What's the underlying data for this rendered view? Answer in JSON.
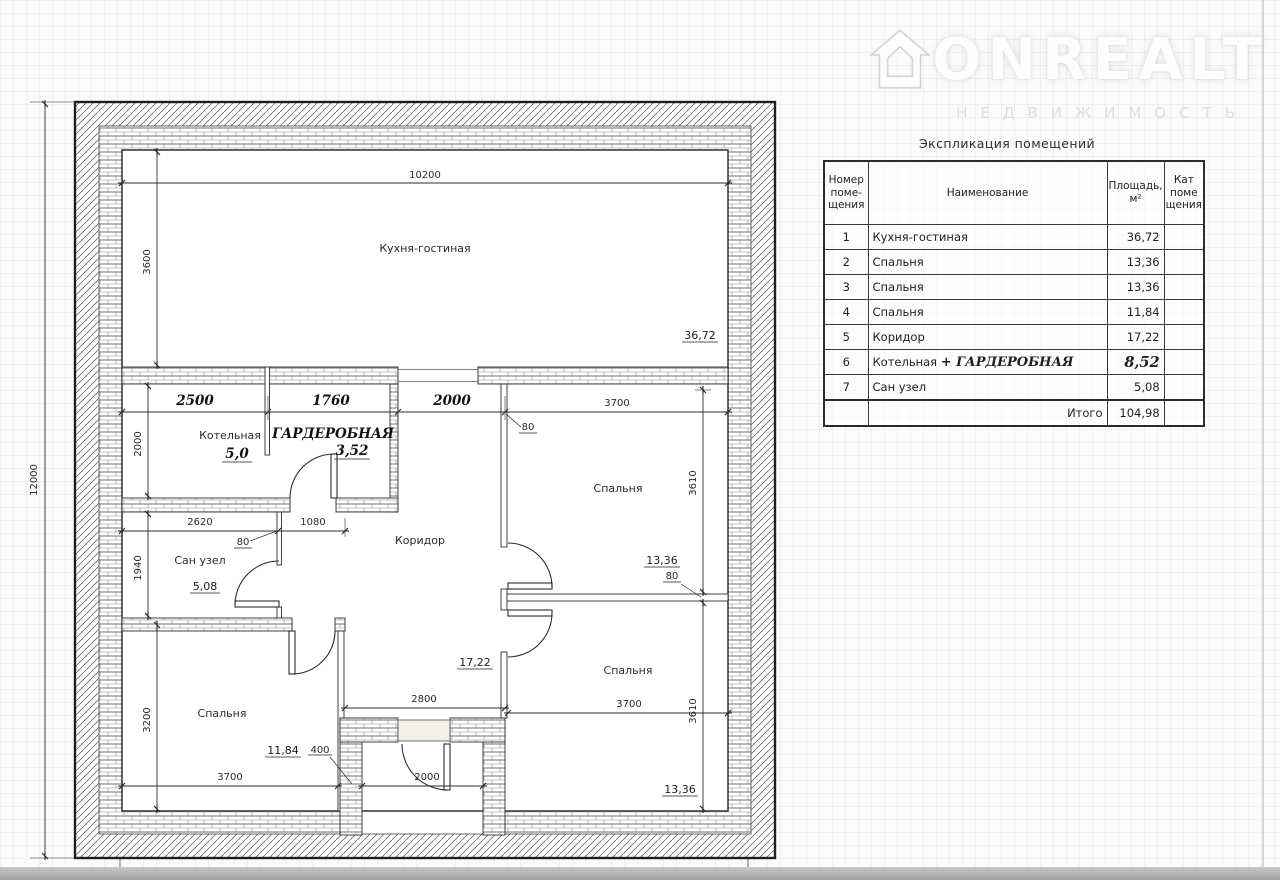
{
  "watermark": {
    "brand": "ONREALT",
    "subtitle": "НЕДВИЖИМОСТЬ"
  },
  "table": {
    "title": "Экспликация помещений",
    "headers": {
      "number": "Номер\nпоме-\nщения",
      "name": "Наименование",
      "area": "Площадь,\nм²",
      "category": "Кат\nпоме\nщения"
    },
    "rows": [
      {
        "num": "1",
        "name": "Кухня-гостиная",
        "extra": "",
        "area": "36,72"
      },
      {
        "num": "2",
        "name": "Спальня",
        "extra": "",
        "area": "13,36"
      },
      {
        "num": "3",
        "name": "Спальня",
        "extra": "",
        "area": "13,36"
      },
      {
        "num": "4",
        "name": "Спальня",
        "extra": "",
        "area": "11,84"
      },
      {
        "num": "5",
        "name": "Коридор",
        "extra": "",
        "area": "17,22"
      },
      {
        "num": "6",
        "name": "Котельная",
        "extra": "+ ГАРДЕРОБНАЯ",
        "area": "8,52"
      },
      {
        "num": "7",
        "name": "Сан узел",
        "extra": "",
        "area": "5,08"
      }
    ],
    "total_label": "Итого",
    "total_value": "104,98"
  },
  "plan": {
    "labels": {
      "kitchen": "Кухня-гостиная",
      "boiler": "Котельная",
      "wardrobe": "ГАРДЕРОБНАЯ",
      "bathroom": "Сан узел",
      "corridor": "Коридор",
      "bedroom": "Спальня"
    },
    "areas": {
      "kitchen": "36,72",
      "boiler": "5,0",
      "wardrobe": "3,52",
      "bathroom": "5,08",
      "corridor": "17,22",
      "bedroom_tr": "13,36",
      "bedroom_br": "13,36",
      "bedroom_bl": "11,84"
    },
    "dims": {
      "total_height": "12000",
      "kitchen_width": "10200",
      "kitchen_height": "3600",
      "boiler_width": "2500",
      "wardrobe_width": "1760",
      "hall_width": "2000",
      "bedroom_tr_width": "3700",
      "boiler_height": "2000",
      "bath_width": "2620",
      "pass_width": "1080",
      "bath_height": "1940",
      "bedroom_bl_height": "3200",
      "bedroom_bl_width": "3700",
      "hall_bottom_width": "2800",
      "bedroom_br_width": "3700",
      "bedroom_tr_height": "3610",
      "bedroom_br_height": "3610",
      "entry_width": "2000",
      "wall_400": "400",
      "wall_80": "80"
    }
  }
}
